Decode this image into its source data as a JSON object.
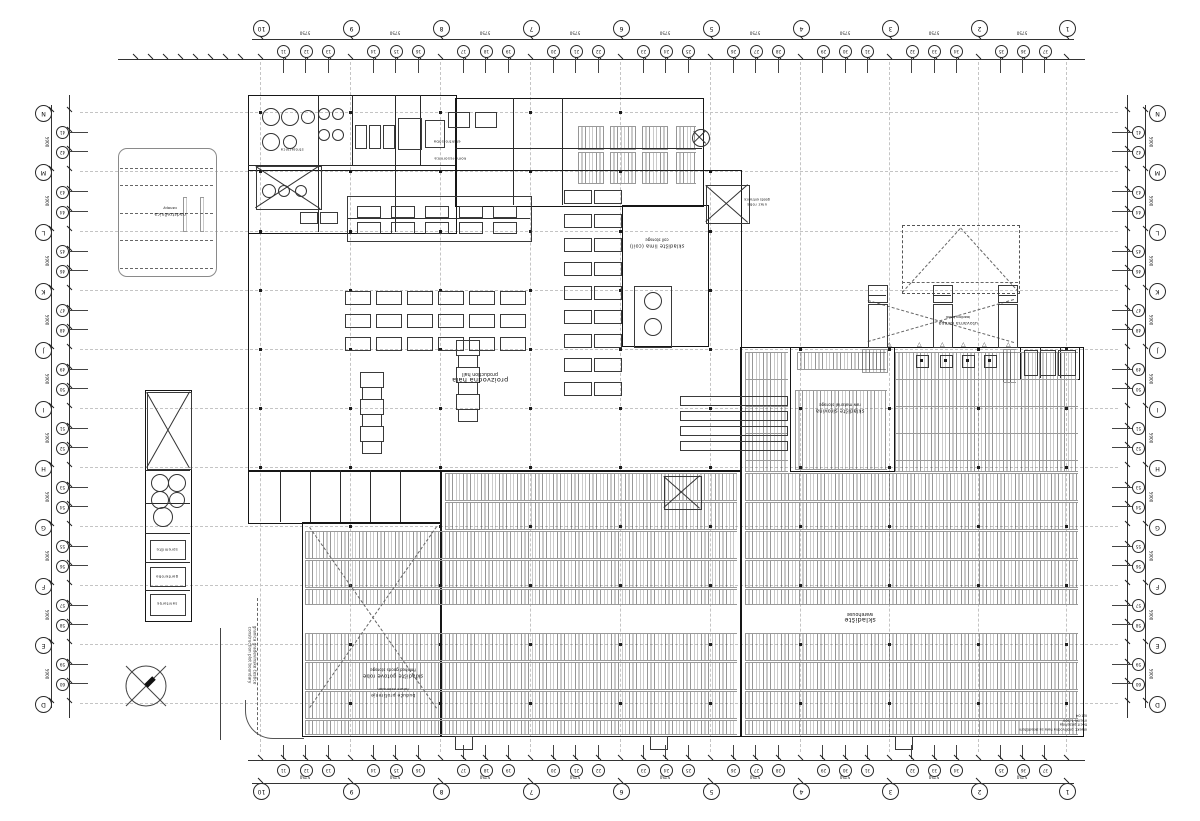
{
  "colors": {
    "ink": "#161616",
    "thin_line": "#3a3a3a",
    "grid_dash": "#c4c4c4",
    "hatch": "#555555",
    "background": "#ffffff"
  },
  "labels": {
    "production_hall": {
      "hr": "proizvodna hala",
      "en": "production hall"
    },
    "warehouse": {
      "hr": "skladište",
      "en": "warehouse"
    },
    "coil_storage": {
      "hr": "skladište lima (coil)",
      "en": "coil storage"
    },
    "mid_storage": {
      "hr": "skladište sirovina",
      "en": "raw material storage"
    },
    "finished_goods": {
      "hr": "skladište gotove robe",
      "en": "finished goods storage"
    },
    "future_extension": {
      "hr": "buduće proširenje",
      "en": "future extension"
    },
    "loading_bank": {
      "hr": "utovarna rampa",
      "en": "loading bank"
    },
    "goods_entrance": {
      "hr": "ulaz robe",
      "en": "goods entrance"
    },
    "canopy": {
      "hr": "nadstrešnica",
      "en": "canopy"
    },
    "plot_boundary": {
      "hr": "granica građevinske čestice",
      "en": "construction plot boundary"
    },
    "plant_room": {
      "hr": "strojarnica",
      "en": "plant room"
    },
    "el_room": {
      "hr": "elektro soba",
      "en": "el. room"
    },
    "compressor": {
      "hr": "kompresornica",
      "en": "compressor room"
    },
    "storage_small": {
      "hr": "spremište",
      "en": "storage"
    },
    "lockers": {
      "hr": "garderoba",
      "en": "lockers"
    },
    "sanitary": {
      "hr": "sanitarije",
      "en": "toilets"
    },
    "stamp": {
      "line1": "objekt: proizvodna hala sa skladištem",
      "line2": "tlocrt prizemlja",
      "line3": "mjerilo 1:200",
      "line4": "list 04"
    }
  },
  "grid": {
    "col_x": [
      260,
      350,
      440,
      530,
      620,
      710,
      800,
      889,
      978,
      1066
    ],
    "col_labels": [
      "10",
      "9",
      "8",
      "7",
      "6",
      "5",
      "4",
      "3",
      "2",
      "1"
    ],
    "row_y": [
      112,
      171,
      231,
      290,
      349,
      408,
      467,
      526,
      585,
      644,
      703
    ],
    "row_labels": [
      "N",
      "M",
      "L",
      "K",
      "J",
      "I",
      "H",
      "G",
      "F",
      "E",
      "D"
    ],
    "sub_col_labels": [
      "11",
      "12",
      "13",
      "14",
      "15",
      "16",
      "17",
      "18",
      "19",
      "20",
      "21",
      "22",
      "23",
      "24",
      "25",
      "26",
      "27",
      "28",
      "29",
      "30",
      "31",
      "32",
      "33",
      "34",
      "35",
      "36",
      "37"
    ],
    "sub_row_labels": [
      "41",
      "42",
      "43",
      "44",
      "45",
      "46",
      "47",
      "48",
      "49",
      "50",
      "51",
      "52",
      "53",
      "54",
      "55",
      "56",
      "57",
      "58",
      "59",
      "60"
    ],
    "bay_dim": "5750",
    "bay_dim_v": "5900",
    "wing_tick_x": [
      135,
      150,
      165,
      180,
      195,
      210,
      225,
      240
    ]
  },
  "plan": {
    "walls": [
      [
        248,
        95,
        207,
        137
      ],
      [
        455,
        98,
        247,
        107
      ],
      [
        248,
        170,
        492,
        300
      ],
      [
        622,
        205,
        85,
        140
      ],
      [
        740,
        347,
        342,
        388
      ],
      [
        440,
        470,
        300,
        265
      ],
      [
        302,
        522,
        138,
        213
      ],
      [
        248,
        470,
        192,
        52
      ],
      [
        790,
        347,
        103,
        123
      ],
      [
        145,
        390,
        45,
        230
      ],
      [
        1020,
        347,
        58,
        31
      ]
    ],
    "thin_rects": [
      [
        118,
        148,
        97,
        127
      ]
    ],
    "inner_v": [
      [
        318,
        95,
        137
      ],
      [
        352,
        95,
        70
      ],
      [
        395,
        95,
        137
      ],
      [
        420,
        95,
        70
      ],
      [
        513,
        98,
        107
      ],
      [
        562,
        98,
        107
      ],
      [
        280,
        470,
        52
      ],
      [
        310,
        470,
        52
      ],
      [
        340,
        470,
        52
      ],
      [
        370,
        470,
        52
      ],
      [
        400,
        470,
        52
      ],
      [
        1040,
        347,
        31
      ],
      [
        1060,
        347,
        31
      ]
    ],
    "inner_h": [
      [
        248,
        165,
        207
      ],
      [
        455,
        148,
        247
      ],
      [
        145,
        470,
        45
      ],
      [
        145,
        503,
        45
      ],
      [
        145,
        533,
        45
      ],
      [
        145,
        562,
        45
      ],
      [
        145,
        590,
        45
      ]
    ],
    "hatch": [
      [
        445,
        473,
        292,
        26
      ],
      [
        445,
        502,
        292,
        26
      ],
      [
        305,
        531,
        432,
        26
      ],
      [
        305,
        560,
        432,
        26
      ],
      [
        305,
        589,
        432,
        14
      ],
      [
        305,
        633,
        432,
        26
      ],
      [
        305,
        662,
        432,
        26
      ],
      [
        305,
        691,
        432,
        26
      ],
      [
        305,
        720,
        432,
        13
      ],
      [
        745,
        352,
        43,
        26
      ],
      [
        895,
        352,
        183,
        26
      ],
      [
        745,
        379,
        43,
        26
      ],
      [
        895,
        379,
        183,
        26
      ],
      [
        745,
        406,
        43,
        26
      ],
      [
        895,
        406,
        183,
        26
      ],
      [
        745,
        433,
        43,
        26
      ],
      [
        895,
        433,
        183,
        26
      ],
      [
        745,
        460,
        43,
        10
      ],
      [
        895,
        460,
        183,
        10
      ],
      [
        745,
        473,
        333,
        26
      ],
      [
        745,
        502,
        333,
        26
      ],
      [
        745,
        531,
        333,
        26
      ],
      [
        745,
        560,
        333,
        26
      ],
      [
        745,
        589,
        333,
        14
      ],
      [
        745,
        633,
        333,
        26
      ],
      [
        745,
        662,
        333,
        26
      ],
      [
        745,
        691,
        333,
        26
      ],
      [
        745,
        720,
        333,
        13
      ],
      [
        797,
        352,
        89,
        16
      ],
      [
        795,
        390,
        92,
        78
      ],
      [
        862,
        349,
        26,
        22
      ],
      [
        1003,
        349,
        13,
        32
      ],
      [
        578,
        126,
        26,
        22
      ],
      [
        610,
        126,
        26,
        22
      ],
      [
        642,
        126,
        26,
        22
      ],
      [
        676,
        126,
        20,
        22
      ],
      [
        578,
        152,
        26,
        30
      ],
      [
        610,
        152,
        26,
        30
      ],
      [
        642,
        152,
        26,
        30
      ],
      [
        676,
        152,
        20,
        30
      ],
      [
        183,
        197,
        4,
        33
      ],
      [
        200,
        197,
        4,
        33
      ]
    ],
    "xboxes": [
      [
        664,
        476,
        36,
        32
      ],
      [
        706,
        185,
        42,
        37
      ],
      [
        147,
        392,
        43,
        76
      ],
      [
        256,
        166,
        64,
        42
      ]
    ],
    "dashed_rects": [
      [
        902,
        225,
        116,
        67
      ]
    ],
    "dashed_segs": [
      [
        902,
        292,
        960,
        228
      ],
      [
        1018,
        292,
        960,
        228
      ],
      [
        902,
        282,
        1018,
        282
      ],
      [
        310,
        527,
        437,
        708
      ],
      [
        437,
        527,
        310,
        708
      ],
      [
        868,
        300,
        1014,
        342
      ],
      [
        1014,
        300,
        868,
        342
      ],
      [
        258,
        598,
        258,
        735
      ]
    ],
    "solid_segs": [
      [
        694,
        131,
        706,
        143
      ],
      [
        706,
        131,
        694,
        143
      ],
      [
        347,
        218,
        530,
        218
      ]
    ],
    "machine_rects": [
      [
        347,
        196,
        183,
        44
      ],
      [
        634,
        286,
        36,
        60
      ],
      [
        1024,
        350,
        12,
        24
      ],
      [
        1040,
        350,
        14,
        24
      ],
      [
        1058,
        350,
        16,
        24
      ],
      [
        355,
        125,
        10,
        22
      ],
      [
        369,
        125,
        10,
        22
      ],
      [
        383,
        125,
        10,
        22
      ],
      [
        398,
        118,
        22,
        30
      ],
      [
        425,
        120,
        18,
        26
      ],
      [
        300,
        212,
        16,
        10
      ],
      [
        320,
        212,
        16,
        10
      ],
      [
        448,
        112,
        20,
        14
      ],
      [
        475,
        112,
        20,
        14
      ],
      [
        150,
        540,
        34,
        18
      ],
      [
        150,
        567,
        34,
        18
      ],
      [
        150,
        594,
        34,
        20
      ]
    ],
    "bench_grids": [
      {
        "cols": [
          357,
          391,
          425,
          459,
          493
        ],
        "rows": [
          206,
          222
        ],
        "w": 22,
        "h": 10
      },
      {
        "cols": [
          345,
          376,
          407,
          438,
          469,
          500
        ],
        "rows": [
          291,
          314,
          337
        ],
        "w": 24,
        "h": 12
      },
      {
        "cols": [
          564,
          594
        ],
        "rows": [
          190,
          214,
          238,
          262,
          286,
          310,
          334,
          358,
          382
        ],
        "w": 26,
        "h": 12
      }
    ],
    "stacks": [
      [
        360,
        372
      ],
      [
        456,
        340
      ]
    ],
    "racks": {
      "x": 680,
      "ys": [
        396,
        411,
        426,
        441
      ],
      "w": 106,
      "h": 8
    },
    "trucks": {
      "xs": [
        868,
        933,
        998
      ],
      "y": 285,
      "w": 18,
      "cab_h": 16,
      "body_h": 42
    },
    "bumpers": {
      "xs": [
        916,
        940,
        962,
        984
      ],
      "y": 355,
      "w": 11,
      "h": 11
    },
    "chevrons": {
      "xs": [
        890,
        920,
        943,
        964,
        985,
        1009
      ],
      "y": 341
    },
    "circles": [
      [
        270,
        116,
        8
      ],
      [
        289,
        116,
        8
      ],
      [
        307,
        116,
        6
      ],
      [
        270,
        141,
        8
      ],
      [
        289,
        141,
        6
      ],
      [
        323,
        113,
        5
      ],
      [
        337,
        113,
        5
      ],
      [
        323,
        134,
        5
      ],
      [
        337,
        134,
        5
      ],
      [
        268,
        190,
        6
      ],
      [
        283,
        190,
        5
      ],
      [
        300,
        190,
        5
      ],
      [
        652,
        300,
        8
      ],
      [
        652,
        326,
        8
      ],
      [
        159,
        482,
        8
      ],
      [
        176,
        482,
        8
      ],
      [
        159,
        499,
        8
      ],
      [
        176,
        499,
        7
      ],
      [
        162,
        516,
        9
      ],
      [
        700,
        137,
        8
      ]
    ],
    "south_doors": [
      [
        455,
        736
      ],
      [
        650,
        736
      ],
      [
        895,
        736
      ]
    ],
    "roads": {
      "vline": [
        220,
        628,
        112
      ],
      "curb": [
        245,
        700,
        58,
        38
      ],
      "lanes": [
        [
          120,
          168,
          93
        ],
        [
          120,
          185,
          93
        ],
        [
          120,
          213,
          93
        ],
        [
          120,
          240,
          93
        ],
        [
          120,
          268,
          93
        ]
      ]
    }
  }
}
